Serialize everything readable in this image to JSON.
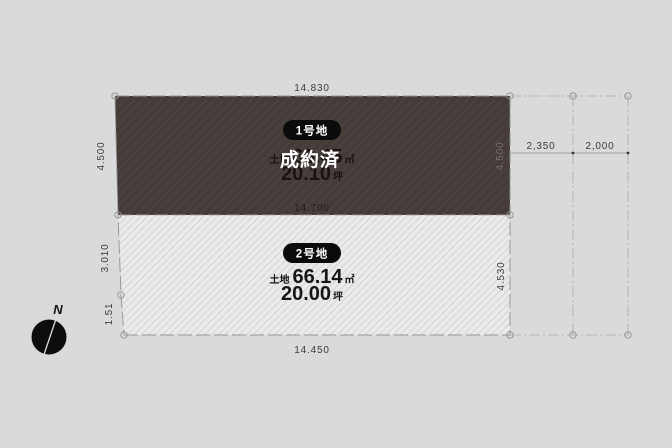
{
  "diagram": {
    "type": "land-plot-plan",
    "background_color": "#d9dada",
    "plots": [
      {
        "badge": "1号地",
        "status": "成約済",
        "area_label": "土地",
        "area_value": "66.45",
        "area_unit": "㎡",
        "tsubo_value": "20.10",
        "tsubo_unit": "坪",
        "fill": "#453c3a",
        "hatch_color": "#4e4543",
        "badge_color": "#0b0b0b"
      },
      {
        "badge": "2号地",
        "status": "",
        "area_label": "土地",
        "area_value": "66.14",
        "area_unit": "㎡",
        "tsubo_value": "20.00",
        "tsubo_unit": "坪",
        "fill": "#e9eaea",
        "hatch_color": "#d2d3d3",
        "badge_color": "#0b0b0b"
      }
    ],
    "dimensions": {
      "top_width": "14.830",
      "middle_width": "14.700",
      "bottom_width": "14.450",
      "left_upper": "4.500",
      "left_middle": "3.010",
      "left_lower": "1.51",
      "right_upper": "4.500",
      "right_lower": "4.530",
      "offset_left": "2,350",
      "offset_right": "2,000"
    },
    "compass": {
      "label": "N"
    }
  }
}
